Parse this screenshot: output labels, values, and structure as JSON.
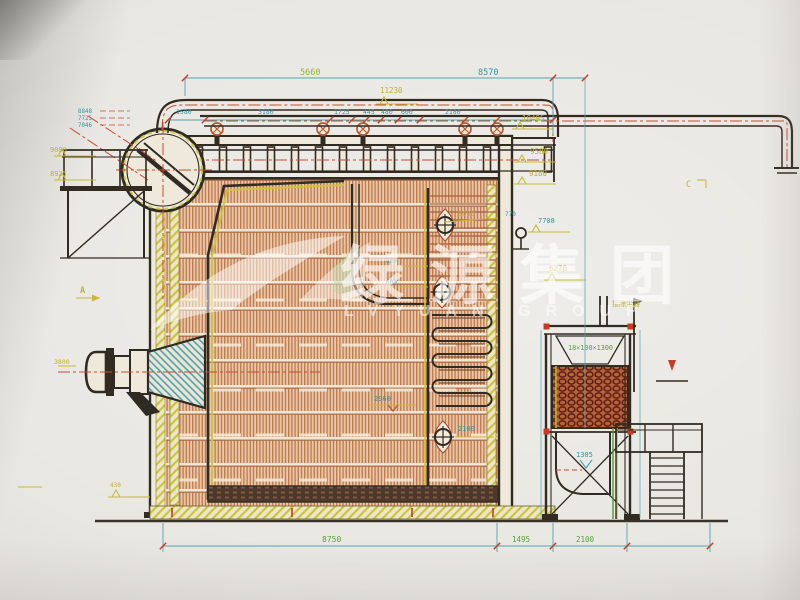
{
  "watermark": {
    "cn": "绿源集团",
    "en": "LVYUAN GROUP"
  },
  "view_markers": {
    "a": "A",
    "c": "C"
  },
  "dimensions": {
    "top": {
      "left_span": "5660",
      "right_span": "8570"
    },
    "upper_row": [
      "1580",
      "3180",
      "1725",
      "445",
      "480",
      "600",
      "2180"
    ],
    "bottom": {
      "boiler": "8750",
      "gap": "1495",
      "economizer": "2100"
    },
    "interior": {
      "screen_pitch_a": "620",
      "screen_pitch_b": "600",
      "grate_a": "2960",
      "grate_b": "2100",
      "burner_width": "1480"
    }
  },
  "elevations": {
    "left_small": [
      "8848",
      "7725",
      "7046"
    ],
    "left": [
      "9080",
      "8925"
    ],
    "top_center": "11230",
    "right": [
      "10495",
      "9580",
      "9180"
    ],
    "mid": {
      "manhole": "8600",
      "offset": "770",
      "outlet": "7708",
      "duct": "6270"
    },
    "low": {
      "econ": "1305",
      "base": "430",
      "burner_cl": "3800"
    }
  },
  "economizer": {
    "tube_spec": "18×100×1300",
    "duct_note": "接除尘器"
  }
}
